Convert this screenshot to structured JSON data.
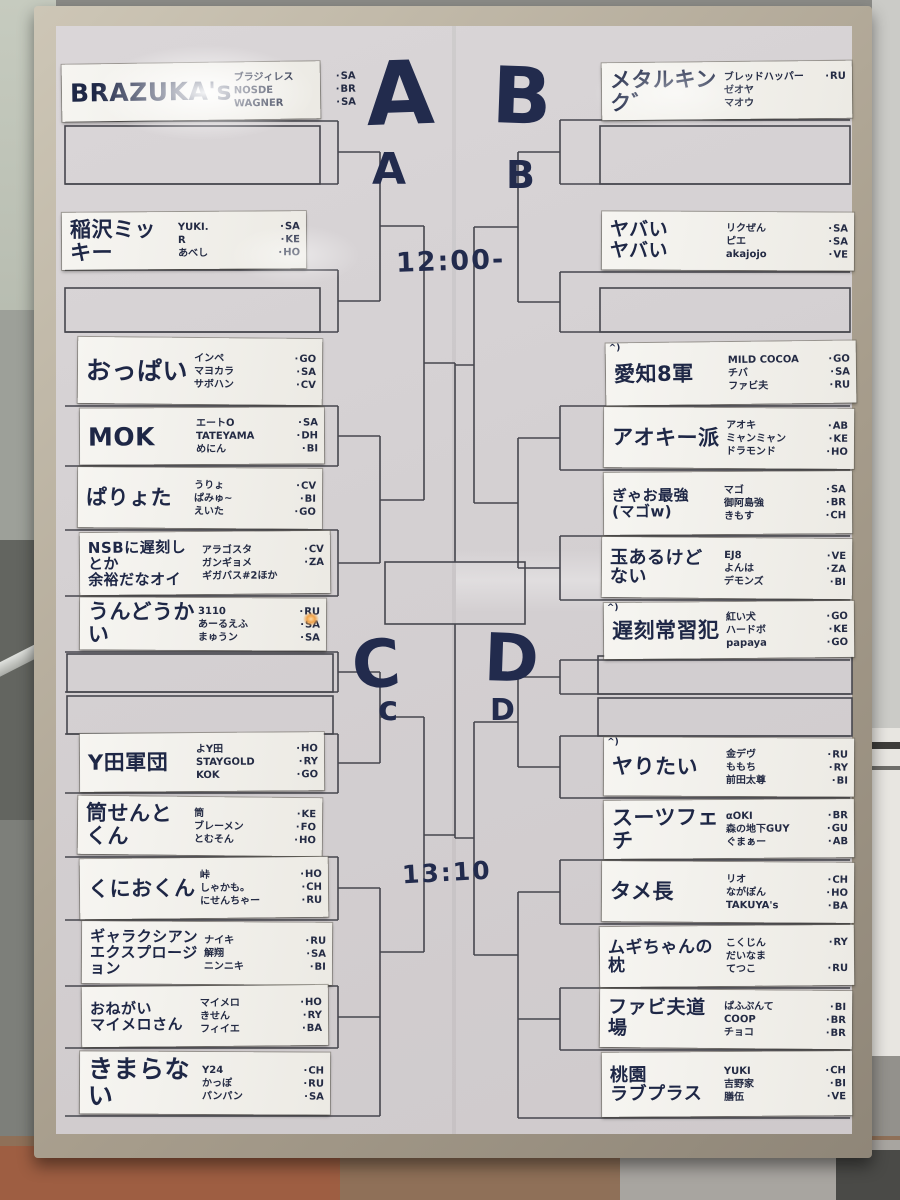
{
  "scene": {
    "letters": {
      "A_big": "A",
      "B_big": "B",
      "A_small": "A",
      "B_small": "B",
      "C_big": "C",
      "C_small": "c",
      "D_big": "D",
      "D_small": "D"
    },
    "time_top": "12:00-",
    "time_bottom": "13:10",
    "colors": {
      "ink": "#222b4d",
      "line": "#46464e",
      "board": "#d6d2d4",
      "frame": "#a79d8c",
      "strip": "#f4f3ee"
    }
  },
  "teams_left": [
    {
      "name": "BRAZUKA's",
      "players": [
        {
          "n": "ブラジィレス",
          "t": "SA"
        },
        {
          "n": "NOSDE",
          "t": "BR"
        },
        {
          "n": "WAGNER",
          "t": "SA"
        }
      ]
    },
    {
      "name": "稲沢ミッキー",
      "players": [
        {
          "n": "YUKI.",
          "t": "SA"
        },
        {
          "n": "R",
          "t": "KE"
        },
        {
          "n": "あべし",
          "t": "HO"
        }
      ]
    },
    {
      "name": "おっぱい",
      "players": [
        {
          "n": "インペ",
          "t": "GO"
        },
        {
          "n": "マヨカラ",
          "t": "SA"
        },
        {
          "n": "サボハン",
          "t": "CV"
        }
      ]
    },
    {
      "name": "MOK",
      "players": [
        {
          "n": "エートO",
          "t": "SA"
        },
        {
          "n": "TATEYAMA",
          "t": "DH"
        },
        {
          "n": "めにん",
          "t": "BI"
        }
      ]
    },
    {
      "name": "ぱりょた",
      "players": [
        {
          "n": "うりょ",
          "t": "CV"
        },
        {
          "n": "ぱみゅ~",
          "t": "BI"
        },
        {
          "n": "えいた",
          "t": "GO"
        }
      ]
    },
    {
      "name": "NSBに遅刻しとか\n余裕だなオイ",
      "players": [
        {
          "n": "アラゴスタ",
          "t": "CV"
        },
        {
          "n": "ガンギョメ",
          "t": "ZA"
        },
        {
          "n": "ギガバス#2ほか",
          "t": ""
        }
      ]
    },
    {
      "name": "うんどうかい",
      "players": [
        {
          "n": "3110",
          "t": "RU"
        },
        {
          "n": "あーるえふ",
          "t": "SA"
        },
        {
          "n": "まゅうン",
          "t": "SA"
        }
      ]
    },
    {
      "name": "Y田軍団",
      "players": [
        {
          "n": "よY田",
          "t": "HO"
        },
        {
          "n": "STAYGOLD",
          "t": "RY"
        },
        {
          "n": "KOK",
          "t": "GO"
        }
      ]
    },
    {
      "name": "筒せんとくん",
      "players": [
        {
          "n": "筒",
          "t": "KE"
        },
        {
          "n": "ブレーメン",
          "t": "FO"
        },
        {
          "n": "とむそん",
          "t": "HO"
        }
      ]
    },
    {
      "name": "くにおくん",
      "players": [
        {
          "n": "峠",
          "t": "HO"
        },
        {
          "n": "しゃかも。",
          "t": "CH"
        },
        {
          "n": "にせんちゃー",
          "t": "RU"
        }
      ]
    },
    {
      "name": "ギャラクシアン\nエクスプロージョン",
      "players": [
        {
          "n": "ナイキ",
          "t": "RU"
        },
        {
          "n": "解翔",
          "t": "SA"
        },
        {
          "n": "ニンニキ",
          "t": "BI"
        }
      ]
    },
    {
      "name": "おねがい\nマイメロさん",
      "players": [
        {
          "n": "マイメロ",
          "t": "HO"
        },
        {
          "n": "きせん",
          "t": "RY"
        },
        {
          "n": "フィイエ",
          "t": "BA"
        }
      ]
    },
    {
      "name": "きまらない",
      "players": [
        {
          "n": "Y24",
          "t": "CH"
        },
        {
          "n": "かっぽ",
          "t": "RU"
        },
        {
          "n": "パンパン",
          "t": "SA"
        }
      ]
    }
  ],
  "teams_right": [
    {
      "name": "メタルキンク゛",
      "players": [
        {
          "n": "ブレッドハッパー",
          "t": "RU"
        },
        {
          "n": "ゼオヤ",
          "t": ""
        },
        {
          "n": "マオウ",
          "t": ""
        }
      ]
    },
    {
      "name": "ヤバい\nヤバい",
      "players": [
        {
          "n": "リクぜん",
          "t": "SA"
        },
        {
          "n": "ピエ",
          "t": "SA"
        },
        {
          "n": "akajojo",
          "t": "VE"
        }
      ]
    },
    {
      "name": "愛知8軍",
      "mark": "^)",
      "players": [
        {
          "n": "MILD COCOA",
          "t": "GO"
        },
        {
          "n": "チバ",
          "t": "SA"
        },
        {
          "n": "ファビ夫",
          "t": "RU"
        }
      ]
    },
    {
      "name": "アオキー派",
      "players": [
        {
          "n": "アオキ",
          "t": "AB"
        },
        {
          "n": "ミャンミャン",
          "t": "KE"
        },
        {
          "n": "ドラモンド",
          "t": "HO"
        }
      ]
    },
    {
      "name": "ぎゃお最強\n(マゴw)",
      "players": [
        {
          "n": "マゴ",
          "t": "SA"
        },
        {
          "n": "御阿島強",
          "t": "BR"
        },
        {
          "n": "きもす",
          "t": "CH"
        }
      ]
    },
    {
      "name": "玉あるけど\nない",
      "players": [
        {
          "n": "EJ8",
          "t": "VE"
        },
        {
          "n": "よんは",
          "t": "ZA"
        },
        {
          "n": "デモンズ",
          "t": "BI"
        }
      ]
    },
    {
      "name": "遅刻常習犯",
      "mark": "^)",
      "players": [
        {
          "n": "紅い犬",
          "t": "GO"
        },
        {
          "n": "ハードボ",
          "t": "KE"
        },
        {
          "n": "papaya",
          "t": "GO"
        }
      ]
    },
    {
      "name": "ヤりたい",
      "mark": "^)",
      "players": [
        {
          "n": "金デヴ",
          "t": "RU"
        },
        {
          "n": "ももち",
          "t": "RY"
        },
        {
          "n": "前田太尊",
          "t": "BI"
        }
      ]
    },
    {
      "name": "スーツフェチ",
      "players": [
        {
          "n": "αOKI",
          "t": "BR"
        },
        {
          "n": "森の地下GUY",
          "t": "GU"
        },
        {
          "n": "ぐまぁー",
          "t": "AB"
        }
      ]
    },
    {
      "name": "タメ長",
      "players": [
        {
          "n": "リオ",
          "t": "CH"
        },
        {
          "n": "ながぽん",
          "t": "HO"
        },
        {
          "n": "TAKUYA's",
          "t": "BA"
        }
      ]
    },
    {
      "name": "ムギちゃんの枕",
      "players": [
        {
          "n": "こくじん",
          "t": "RY"
        },
        {
          "n": "だいなま",
          "t": ""
        },
        {
          "n": "てつこ",
          "t": "RU"
        }
      ]
    },
    {
      "name": "ファビ夫道場",
      "players": [
        {
          "n": "ぱふぷんて",
          "t": "BI"
        },
        {
          "n": "COOP",
          "t": "BR"
        },
        {
          "n": "チョコ",
          "t": "BR"
        }
      ]
    },
    {
      "name": "桃園\nラブプラス",
      "players": [
        {
          "n": "YUKI",
          "t": "CH"
        },
        {
          "n": "吉野家",
          "t": "BI"
        },
        {
          "n": "膳伍",
          "t": "VE"
        }
      ]
    }
  ]
}
